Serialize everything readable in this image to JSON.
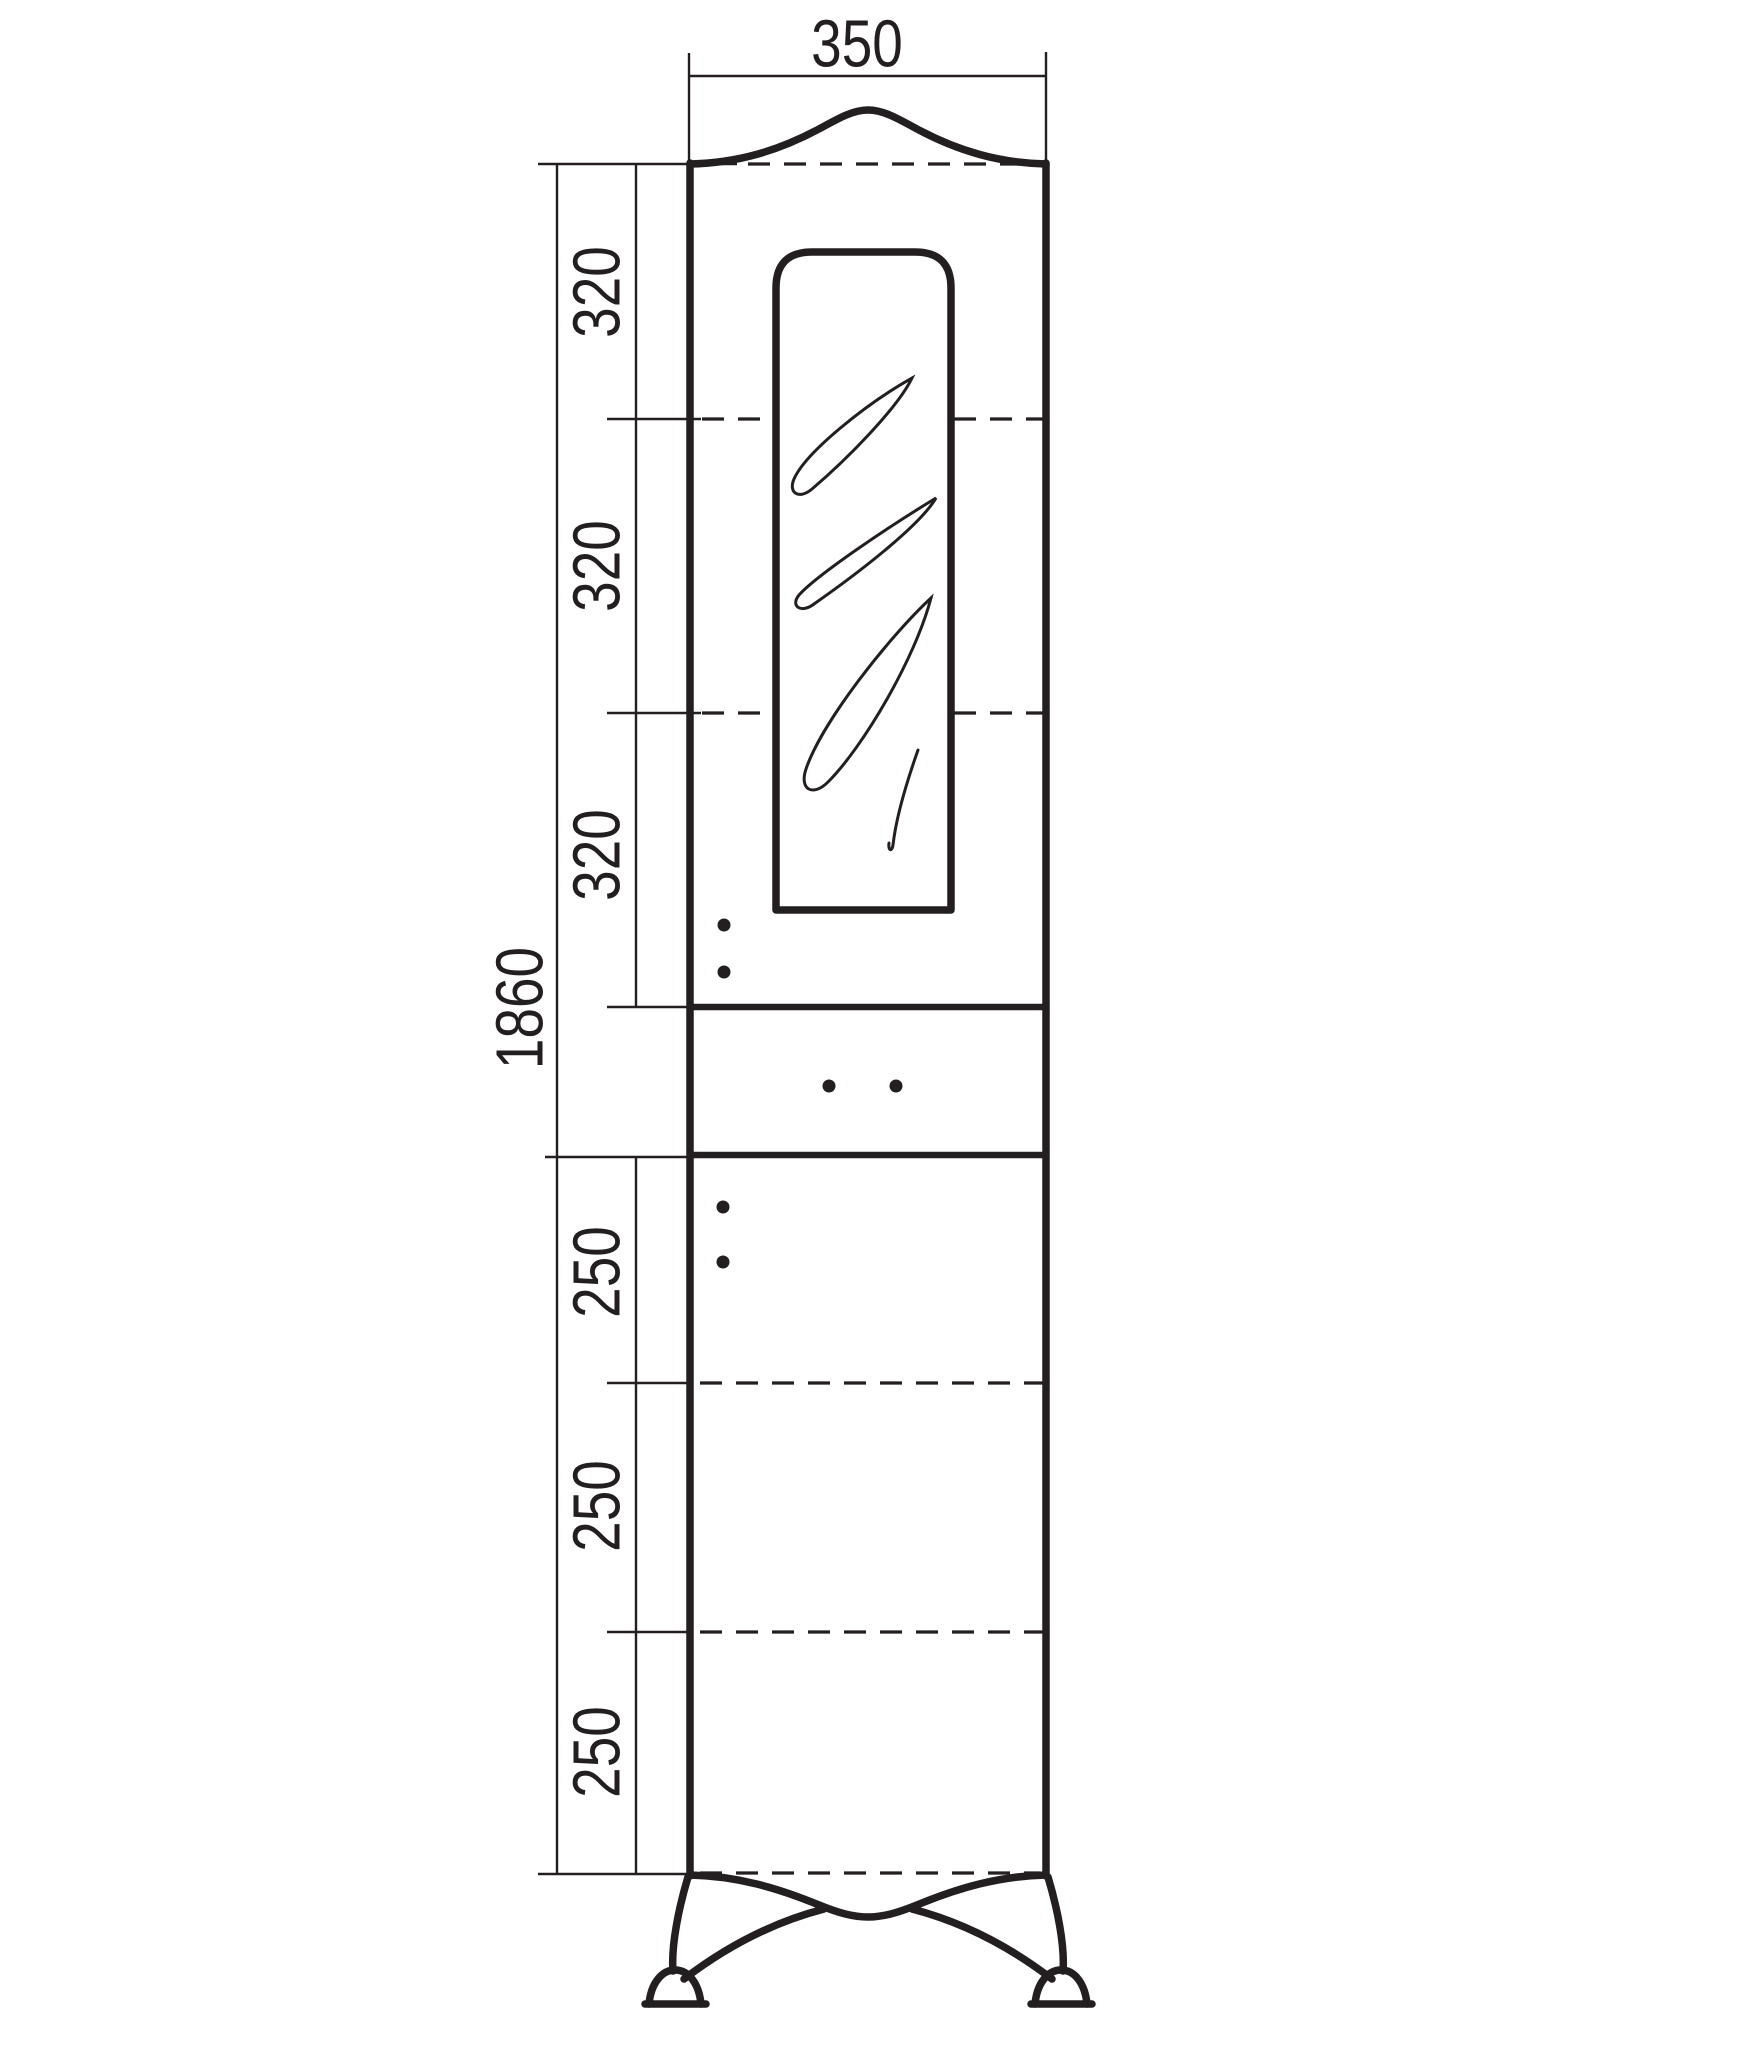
{
  "drawing": {
    "dimension_labels": {
      "width": "350",
      "overall_height": "1860",
      "upper_segments": [
        "320",
        "320",
        "320"
      ],
      "lower_segments": [
        "250",
        "250",
        "250"
      ]
    },
    "colors": {
      "line": "#231f20",
      "background": "#ffffff"
    }
  }
}
